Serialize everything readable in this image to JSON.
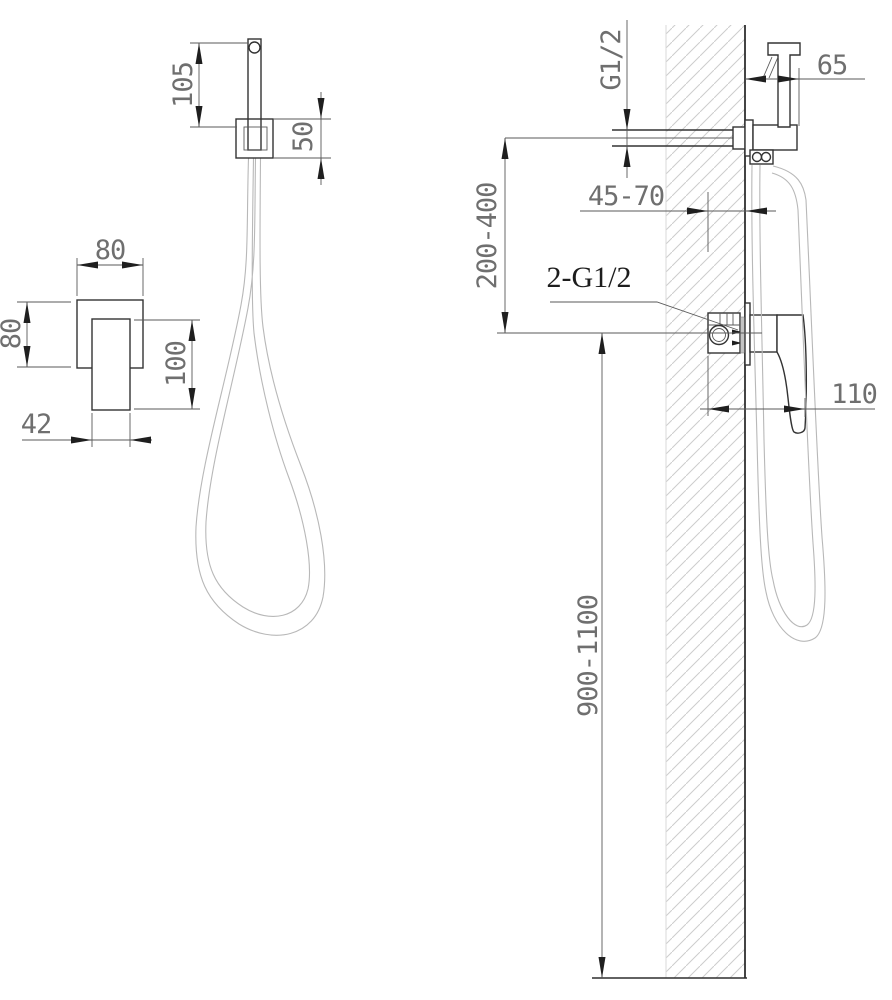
{
  "drawing": {
    "front_view": {
      "dim_sprayer_height": "105",
      "dim_holder_height": "50",
      "dim_plate_width": "80",
      "dim_plate_height": "80",
      "dim_handle_length": "100",
      "dim_handle_width": "42"
    },
    "side_view": {
      "outlet_thread_label": "G1/2",
      "dim_holder_offset": "65",
      "dim_wall_finish_range": "45-70",
      "dim_outlet_to_mixer_range": "200-400",
      "mixer_connections_label": "2-G1/2",
      "dim_mixer_projection": "110",
      "dim_mixer_height_range": "900-1100"
    },
    "colors": {
      "line": "#333333",
      "dim_line": "#5a5a5a",
      "dim_text": "#6f6f6f",
      "hatch": "#cccccc",
      "hose": "#b8b8b8",
      "background": "#ffffff"
    }
  }
}
